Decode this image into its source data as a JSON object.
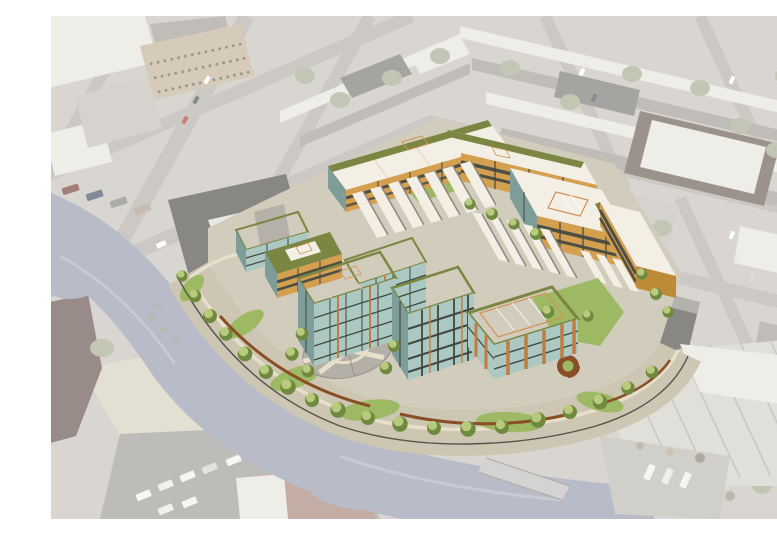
{
  "scene": {
    "type": "aerial-architectural-rendering",
    "view": "oblique bird's-eye aerial view",
    "subject": "Full-color rendering of a proposed multi-building waterfront residential development composited into a faded aerial photograph of an industrial urban neighborhood beside a canal",
    "description": "Oblique aerial photograph of a city neighborhood, desaturated and washed out, with a saturated architectural rendering of a large mixed-use development block in the center. The development has mid-rise buildings with white roofs, peach skylights, green-roof edges, teal glass curtain walls, amber and copper facades, a circular paved plaza, interior lawn courtyards, and a landscaped waterfront esplanade with trees, corten steel planters and a fence along a gray-blue canal that curves around the site's west and south edges. The surrounding faded context includes warehouses with white roofs, rowhouse blocks, tree-lined streets with parked cars, truck parking lots, a canal bridge, and a large industrial complex in the lower right.",
    "environment_features": [
      "canal water curving along left and bottom",
      "faded industrial warehouses top-left",
      "faded rowhouse blocks top and right",
      "diagonal street grid with parked cars",
      "truck parking lot bottom-left",
      "large white-roofed industrial complex bottom-right",
      "canal bridge bottom-center",
      "shoreline sand and scrub trees"
    ],
    "development_features": [
      "perimeter mid-rise residential bars with amber facades",
      "white roofs with peach skylights and bulkheads",
      "green roof edges and planted roofs",
      "rows of sawtooth skylight roofs",
      "tall teal-glass towers with copper mullions",
      "south pavilion with timber fins and large skylight roof",
      "circular cobble plaza with radial paths",
      "interior lawn courtyard",
      "waterfront esplanade with lawns, trees, corten ribbons and spiral planter",
      "perimeter fence along canal edge"
    ]
  },
  "palette": {
    "white": "#ffffff",
    "photoBase": "#c9c5be",
    "photoStreet": "#b6b2ad",
    "photoPave": "#a3a09b",
    "photoRoofWhite": "#e8e5de",
    "photoRoofMid": "#a5a19b",
    "photoRoofDark": "#807d77",
    "photoRidge": "#b4b1aa",
    "warehouseDark": "#55534e",
    "photoBrick": "#a98a7d",
    "photoBrickDark": "#70635b",
    "photoTan": "#c5b59b",
    "photoTree": "#a6af94",
    "photoLot": "#c4c0b9",
    "sand": "#d8d1c1",
    "water": "#9aa0b0",
    "waterLight": "#b8bcc8",
    "renderGround": "#d2ccbd",
    "esplanade": "#ccc6b3",
    "pathLight": "#e6dfca",
    "lawn": "#9db964",
    "treeBase": "#6f8a3e",
    "treeTop": "#bccd81",
    "roofCream": "#f3efe4",
    "roofGrid": "#ddd3bf",
    "roofPeach": "#f4dbb6",
    "peachFrame": "#d19356",
    "roofGreen": "#7c8643",
    "amber": "#d4a050",
    "amberDark": "#bd8a38",
    "glass": "#abc9c2",
    "glassDark": "#7e9d98",
    "charcoal": "#43483f",
    "copper": "#c07d42",
    "windowDark": "#4d4e44",
    "plazaCobble": "#b4b0a8",
    "cobbleDark": "#97938b",
    "corten": "#8a4e27",
    "fence": "#54544c",
    "carRed": "#b04538",
    "carDark": "#55595f"
  }
}
